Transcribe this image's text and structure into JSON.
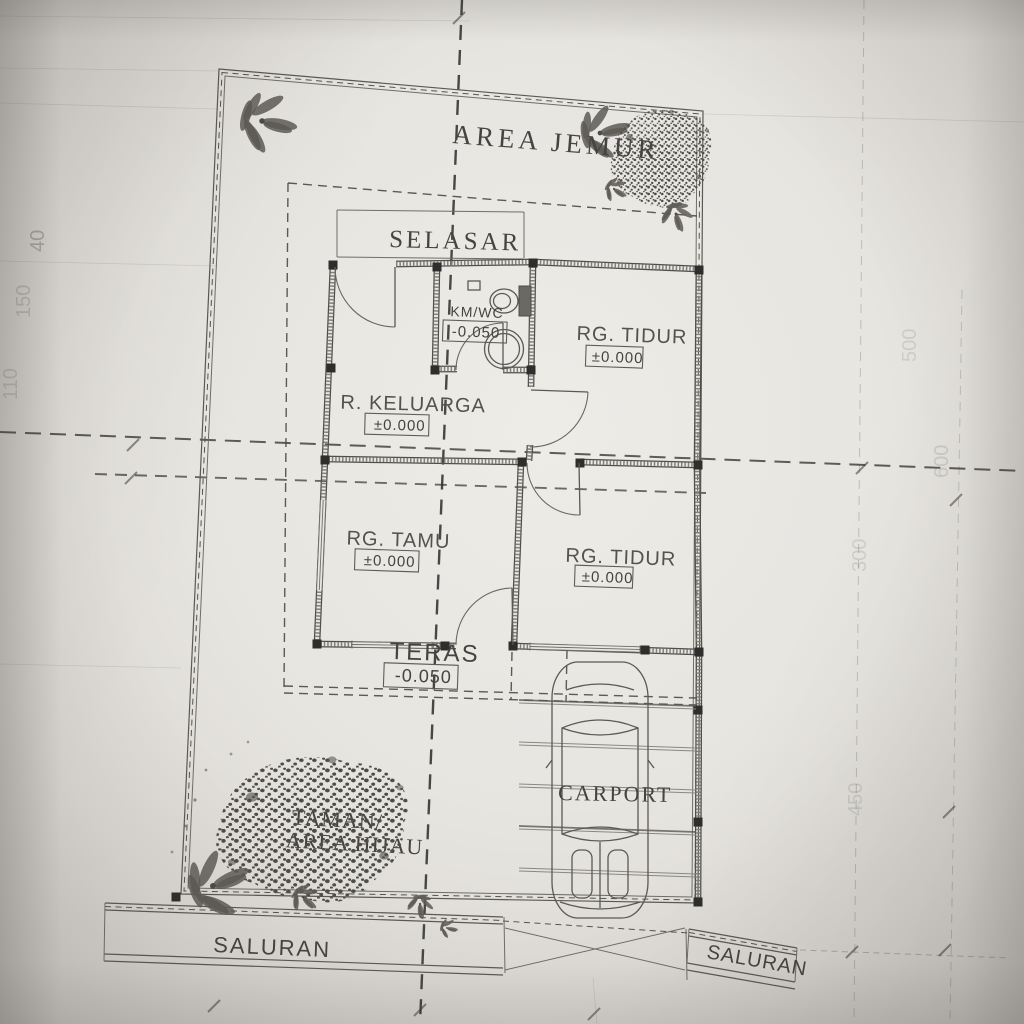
{
  "plan": {
    "outdoor": {
      "area_jemur": "AREA JEMUR",
      "selasar": "SELASAR",
      "teras": {
        "name": "TERAS",
        "level": "-0.050"
      },
      "carport": "CARPORT",
      "taman_line1": "TAMAN/",
      "taman_line2": "AREA HIJAU",
      "saluran_left": "SALURAN",
      "saluran_right": "SALURAN"
    },
    "rooms": {
      "km_wc": {
        "name": "KM/WC",
        "level": "-0.050"
      },
      "rg_tidur_top": {
        "name": "RG. TIDUR",
        "level": "±0.000"
      },
      "r_keluarga": {
        "name": "R. KELUARGA",
        "level": "±0.000"
      },
      "rg_tamu": {
        "name": "RG. TAMU",
        "level": "±0.000"
      },
      "rg_tidur_bottom": {
        "name": "RG. TIDUR",
        "level": "±0.000"
      }
    },
    "dimensions": {
      "left": [
        "40",
        "150",
        "110"
      ],
      "right": [
        "500",
        "600",
        "300",
        "450"
      ]
    },
    "colors": {
      "paper": "#e9e7e2",
      "ink": "#4a4947",
      "faint_ink": "#8d8b85"
    }
  }
}
